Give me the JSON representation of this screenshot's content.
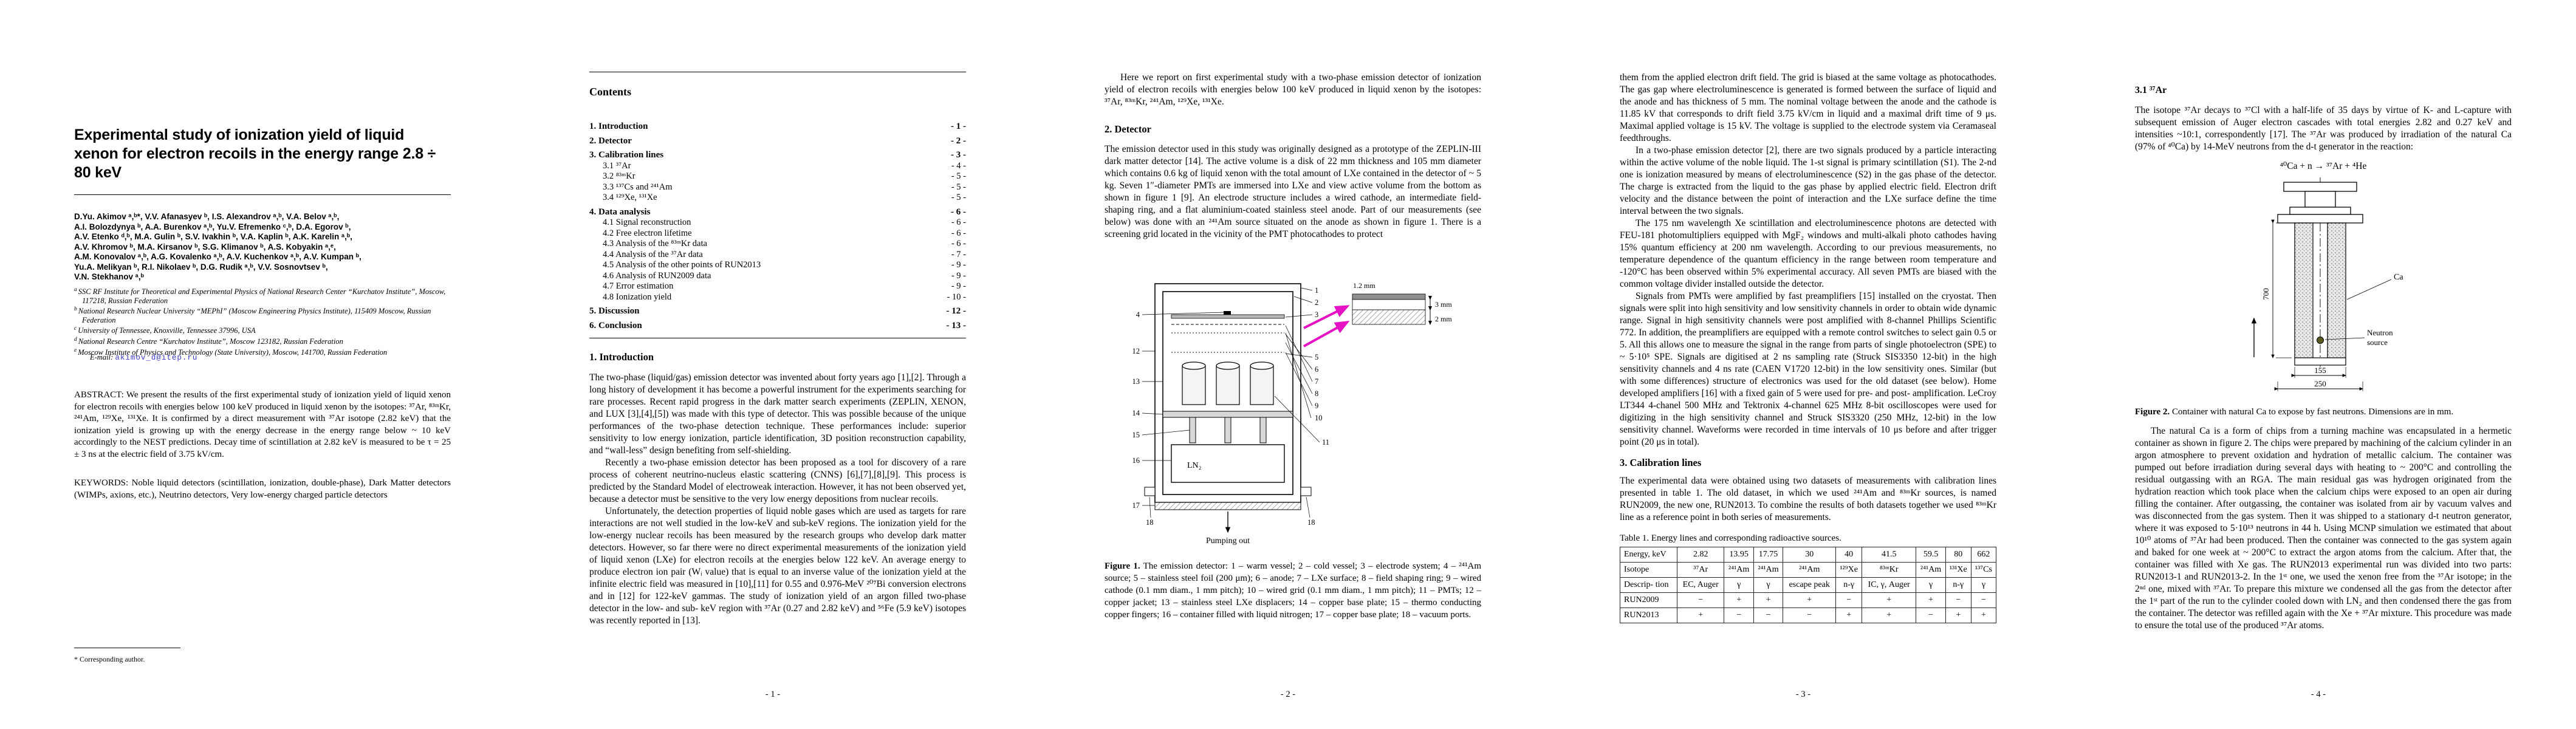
{
  "colors": {
    "magenta_arrow": "#e513c4",
    "email_link": "#3b3bc8",
    "paper_background": "#ffffff",
    "text": "#000000"
  },
  "p1": {
    "title": "Experimental study of ionization yield of liquid xenon for electron recoils in the energy range 2.8 ÷ 80 keV",
    "authors": [
      "D.Yu. Akimov ᵃ,ᵇ*, V.V. Afanasyev ᵇ, I.S. Alexandrov ᵃ,ᵇ, V.A. Belov ᵃ,ᵇ,",
      "A.I. Bolozdynya ᵇ, A.A. Burenkov ᵃ,ᵇ, Yu.V. Efremenko ᶜ,ᵇ, D.A. Egorov ᵇ,",
      "A.V. Etenko ᵈ,ᵇ, M.A. Gulin ᵇ, S.V. Ivakhin ᵇ, V.A. Kaplin ᵇ, A.K. Karelin ᵃ,ᵇ,",
      "A.V. Khromov ᵇ, M.A. Kirsanov ᵇ, S.G. Klimanov ᵇ, A.S. Kobyakin ᵃ,ᵉ,",
      "A.M. Konovalov ᵃ,ᵇ, A.G. Kovalenko ᵃ,ᵇ, A.V. Kuchenkov ᵃ,ᵇ, A.V. Kumpan ᵇ,",
      "Yu.A. Melikyan ᵇ, R.I. Nikolaev ᵇ, D.G. Rudik ᵃ,ᵇ, V.V. Sosnovtsev ᵇ,",
      "V.N. Stekhanov ᵃ,ᵇ"
    ],
    "affiliations": [
      {
        "marker": "a",
        "text": "SSC RF Institute for Theoretical and Experimental Physics of National Research Center “Kurchatov Institute”, Moscow, 117218, Russian Federation"
      },
      {
        "marker": "b",
        "text": "National Research Nuclear University “MEPhI” (Moscow Engineering Physics Institute), 115409 Moscow, Russian Federation"
      },
      {
        "marker": "c",
        "text": "University of Tennessee, Knoxville, Tennessee 37996, USA"
      },
      {
        "marker": "d",
        "text": "National Research Centre “Kurchatov Institute”, Moscow 123182, Russian Federation"
      },
      {
        "marker": "e",
        "text": "Moscow Institute of Physics and Technology (State University), Moscow, 141700, Russian Federation"
      }
    ],
    "email_label": "E-mail:",
    "email": "akimov_d@itep.ru",
    "abstract": "ABSTRACT: We present the results of the first experimental study of ionization yield of liquid xenon for electron recoils with energies below 100 keV produced in liquid xenon by the isotopes: ³⁷Ar, ⁸³ᵐKr, ²⁴¹Am, ¹²⁹Xe, ¹³¹Xe. It is confirmed by a direct measurement with ³⁷Ar isotope (2.82 keV) that the ionization yield is growing up with the energy decrease in the energy range below ~ 10 keV accordingly to the NEST predictions. Decay time of scintillation at 2.82 keV is measured to be τ = 25 ± 3 ns at the electric field of 3.75 kV/cm.",
    "keywords": "KEYWORDS: Noble liquid detectors (scintillation, ionization, double-phase), Dark Matter detectors (WIMPs, axions, etc.), Neutrino detectors, Very low-energy charged particle detectors",
    "footnote": "* Corresponding author."
  },
  "p2": {
    "contents_title": "Contents",
    "toc": [
      {
        "label": "1. Introduction",
        "page": "- 1 -"
      },
      {
        "label": "2. Detector",
        "page": "- 2 -"
      },
      {
        "label": "3. Calibration lines",
        "page": "- 3 -"
      },
      {
        "label": "3.1 ³⁷Ar",
        "page": "- 4 -"
      },
      {
        "label": "3.2 ⁸³ᵐKr",
        "page": "- 5 -"
      },
      {
        "label": "3.3 ¹³⁷Cs and ²⁴¹Am",
        "page": "- 5 -"
      },
      {
        "label": "3.4 ¹²⁹Xe, ¹³¹Xe",
        "page": "- 5 -"
      },
      {
        "label": "4. Data analysis",
        "page": "- 6 -"
      },
      {
        "label": "4.1 Signal reconstruction",
        "page": "- 6 -"
      },
      {
        "label": "4.2 Free electron lifetime",
        "page": "- 6 -"
      },
      {
        "label": "4.3 Analysis of the ⁸³ᵐKr data",
        "page": "- 6 -"
      },
      {
        "label": "4.4 Analysis of the ³⁷Ar data",
        "page": "- 7 -"
      },
      {
        "label": "4.5 Analysis of the other points of RUN2013",
        "page": "- 9 -"
      },
      {
        "label": "4.6 Analysis of RUN2009 data",
        "page": "- 9 -"
      },
      {
        "label": "4.7 Error estimation",
        "page": "- 9 -"
      },
      {
        "label": "4.8 Ionization yield",
        "page": "- 10 -"
      },
      {
        "label": "5. Discussion",
        "page": "- 12 -"
      },
      {
        "label": "6. Conclusion",
        "page": "- 13 -"
      }
    ],
    "intro_heading": "1. Introduction",
    "paras": [
      "The two-phase (liquid/gas) emission detector was invented about forty years ago [1],[2]. Through a long history of development it has become a powerful instrument for the experiments searching for rare processes. Recent rapid progress in the dark matter search experiments (ZEPLIN, XENON, and LUX [3],[4],[5]) was made with this type of detector. This was possible because of the unique performances of the two-phase detection technique. These performances include: superior sensitivity to low energy ionization, particle identification, 3D position reconstruction capability, and “wall-less” design benefiting from self-shielding.",
      "Recently a two-phase emission detector has been proposed as a tool for discovery of a rare process of coherent neutrino-nucleus elastic scattering (CNNS) [6],[7],[8],[9]. This process is predicted by the Standard Model of electroweak interaction. However, it has not been observed yet, because a detector must be sensitive to the very low energy depositions from nuclear recoils.",
      "Unfortunately, the detection properties of liquid noble gases which are used as targets for rare interactions are not well studied in the low-keV and sub-keV regions. The ionization yield for the low-energy nuclear recoils has been measured by the research groups who develop dark matter detectors. However, so far there were no direct experimental measurements of the ionization yield of liquid xenon (LXe) for electron recoils at the energies below 122 keV. An average energy to produce electron ion pair (Wᵢ value) that is equal to an inverse value of the ionization yield at the infinite electric field was measured in [10],[11] for 0.55 and 0.976-MeV ²⁰⁷Bi conversion electrons and in [12] for 122-keV gammas. The study of ionization yield of an argon filled two-phase detector in the low- and sub- keV region with ³⁷Ar (0.27 and 2.82 keV) and ⁵⁶Fe (5.9 keV) isotopes was recently reported in [13]."
    ],
    "footer": "- 1 -"
  },
  "p3": {
    "lead": "Here we report on first experimental study with a two-phase emission detector of ionization yield of electron recoils with energies below 100 keV produced in liquid xenon by the isotopes: ³⁷Ar, ⁸³ᵐKr, ²⁴¹Am, ¹²⁹Xe, ¹³¹Xe.",
    "heading": "2. Detector",
    "para": "The emission detector used in this study was originally designed as a prototype of the ZEPLIN-III dark matter detector [14]. The active volume is a disk of 22 mm thickness and 105 mm diameter which contains 0.6 kg of liquid xenon with the total amount of LXe contained in the detector of ~ 5 kg. Seven 1″-diameter PMTs are immersed into LXe and view active volume from the bottom as shown in figure 1 [9]. An electrode structure includes a wired cathode, an intermediate field-shaping ring, and a flat aluminium-coated stainless steel anode. Part of our measurements (see below) was done with an ²⁴¹Am source situated on the anode as shown in figure 1. There is a screening grid located in the vicinity of the PMT photocathodes to protect",
    "fig1": {
      "inset_dims": [
        "1.2 mm",
        "3 mm",
        "2 mm"
      ],
      "ln2": "LN₂",
      "pumping": "Pumping out",
      "callouts_right": [
        "1",
        "2",
        "3",
        "5",
        "6",
        "7",
        "8",
        "9",
        "10"
      ],
      "callouts_left": [
        "4",
        "12",
        "13",
        "14",
        "15",
        "16",
        "17"
      ],
      "callout_pmt": "11",
      "callouts_bottom": [
        "18",
        "18"
      ]
    },
    "caption_prefix": "Figure 1.",
    "caption_text": " The emission detector: 1 – warm vessel; 2 – cold vessel; 3 – electrode system; 4 – ²⁴¹Am source; 5 – stainless steel foil (200 μm); 6 – anode; 7 – LXe surface; 8 – field shaping ring; 9 – wired cathode (0.1 mm diam., 1 mm pitch); 10 – wired grid (0.1 mm diam., 1 mm pitch); 11 – PMTs; 12 – copper jacket; 13 – stainless steel LXe displacers; 14 – copper base plate; 15 – thermo conducting copper fingers; 16 – container filled with liquid nitrogen; 17 – copper base plate; 18 – vacuum ports.",
    "footer": "- 2 -"
  },
  "p4": {
    "paras": [
      "them from the applied electron drift field. The grid is biased at the same voltage as photocathodes. The gas gap where electroluminescence is generated is formed between the surface of liquid and the anode and has thickness of 5 mm. The nominal voltage between the anode and the cathode is 11.85 kV that corresponds to drift field 3.75 kV/cm in liquid and a maximal drift time of 9 μs. Maximal applied voltage is 15 kV. The voltage is supplied to the electrode system via Ceramaseal feedthroughs.",
      "In a two-phase emission detector [2], there are two signals produced by a particle interacting within the active volume of the noble liquid. The 1-st signal is primary scintillation (S1). The 2-nd one is ionization measured by means of electroluminescence (S2) in the gas phase of the detector. The charge is extracted from the liquid to the gas phase by applied electric field. Electron drift velocity and the distance between the point of interaction and the LXe surface define the time interval between the two signals.",
      "The 175 nm wavelength Xe scintillation and electroluminescence photons are detected with FEU-181 photomultipliers equipped with MgF₂ windows and multi-alkali photo cathodes having 15% quantum efficiency at 200 nm wavelength. According to our previous measurements, no temperature dependence of the quantum efficiency in the range between room temperature and -120°C has been observed within 5% experimental accuracy. All seven PMTs are biased with the common voltage divider installed outside the detector.",
      "Signals from PMTs were amplified by fast preamplifiers [15] installed on the cryostat. Then signals were split into high sensitivity and low sensitivity channels in order to obtain wide dynamic range. Signal in high sensitivity channels were post amplified with 8-channel Phillips Scientific 772. In addition, the preamplifiers are equipped with a remote control switches to select gain 0.5 or 5. All this allows one to measure the signal in the range from parts of single photoelectron (SPE) to ~ 5·10⁵ SPE. Signals are digitised at 2 ns sampling rate (Struck SIS3350 12-bit) in the high sensitivity channels and 4 ns rate (CAEN V1720 12-bit) in the low sensitivity ones. Similar (but with some differences) structure of electronics was used for the old dataset (see below). Home developed amplifiers [16] with a fixed gain of 5 were used for pre- and post- amplification. LeCroy LT344 4-chanel 500 MHz and Tektronix 4-channel 625 MHz 8-bit oscilloscopes were used for digitizing in the high sensitivity channel and Struck SIS3320 (250 MHz, 12-bit) in the low sensitivity channel. Waveforms were recorded in time intervals of 10 μs before and after trigger point (20 μs in total)."
    ],
    "calib_heading": "3. Calibration lines",
    "calib_para": "The experimental data were obtained using two datasets of measurements with calibration lines presented in table 1. The old dataset, in which we used ²⁴¹Am and ⁸³ᵐKr sources, is named RUN2009, the new one, RUN2013. To combine the results of both datasets together we used ⁸³ᵐKr line as a reference point in both series of measurements.",
    "table": {
      "caption": "Table 1. Energy lines and corresponding radioactive sources.",
      "rows": [
        [
          "Energy, keV",
          "2.82",
          "13.95",
          "17.75",
          "30",
          "40",
          "41.5",
          "59.5",
          "80",
          "662"
        ],
        [
          "Isotope",
          "³⁷Ar",
          "²⁴¹Am",
          "²⁴¹Am",
          "²⁴¹Am",
          "¹²⁹Xe",
          "⁸³ᵐKr",
          "²⁴¹Am",
          "¹³¹Xe",
          "¹³⁷Cs"
        ],
        [
          "Descrip- tion",
          "EC, Auger",
          "γ",
          "γ",
          "escape peak",
          "n-γ",
          "IC, γ, Auger",
          "γ",
          "n-γ",
          "γ"
        ],
        [
          "RUN2009",
          "−",
          "+",
          "+",
          "+",
          "−",
          "+",
          "+",
          "−",
          "−"
        ],
        [
          "RUN2013",
          "+",
          "−",
          "−",
          "−",
          "+",
          "+",
          "−",
          "+",
          "+"
        ]
      ]
    },
    "footer": "- 3 -"
  },
  "p5": {
    "heading": "3.1 ³⁷Ar",
    "para1": "The isotope ³⁷Ar decays to ³⁷Cl with a half-life of 35 days by virtue of K- and L-capture with subsequent emission of Auger electron cascades with total energies 2.82 and 0.27 keV and intensities ~10:1, correspondently [17]. The ³⁷Ar was produced by irradiation of the natural Ca (97% of ⁴⁰Ca) by 14-MeV neutrons from the d-t generator in the reaction:",
    "formula": "⁴⁰Ca + n → ³⁷Ar + ⁴He",
    "fig2": {
      "ca_label": "Ca",
      "neutron_label_1": "Neutron",
      "neutron_label_2": "source",
      "dim_height": "700",
      "dim_inner": "155",
      "dim_outer": "250"
    },
    "caption_prefix": "Figure 2.",
    "caption_text": " Container with natural Ca to expose by fast neutrons. Dimensions are in mm.",
    "para2": "The natural Ca is a form of chips from a turning machine was encapsulated in a hermetic container as shown in figure 2. The chips were prepared by machining of the calcium cylinder in an argon atmosphere to prevent oxidation and hydration of metallic calcium. The container was pumped out before irradiation during several days with heating to ~ 200°C and controlling the residual outgassing with an RGA. The main residual gas was hydrogen originated from the hydration reaction which took place when the calcium chips were exposed to an open air during filling the container. After outgassing, the container was isolated from air by vacuum valves and was disconnected from the gas system. Then it was shipped to a stationary d-t neutron generator, where it was exposed to 5·10¹³ neutrons in 44 h. Using MCNP simulation we estimated that about 10¹⁰ atoms of ³⁷Ar had been produced. Then the container was connected to the gas system again and baked for one week at ~ 200°C to extract the argon atoms from the calcium. After that, the container was filled with Xe gas. The RUN2013 experimental run was divided into two parts: RUN2013-1 and RUN2013-2. In the 1ˢᵗ one, we used the xenon free from the ³⁷Ar isotope; in the 2ⁿᵈ one, mixed with ³⁷Ar. To prepare this mixture we condensed all the gas from the detector after the 1ˢᵗ part of the run to the cylinder cooled down with LN₂ and then condensed there the gas from the container. The detector was refilled again with the Xe + ³⁷Ar mixture. This procedure was made to ensure the total use of the produced ³⁷Ar atoms.",
    "footer": "- 4 -"
  }
}
